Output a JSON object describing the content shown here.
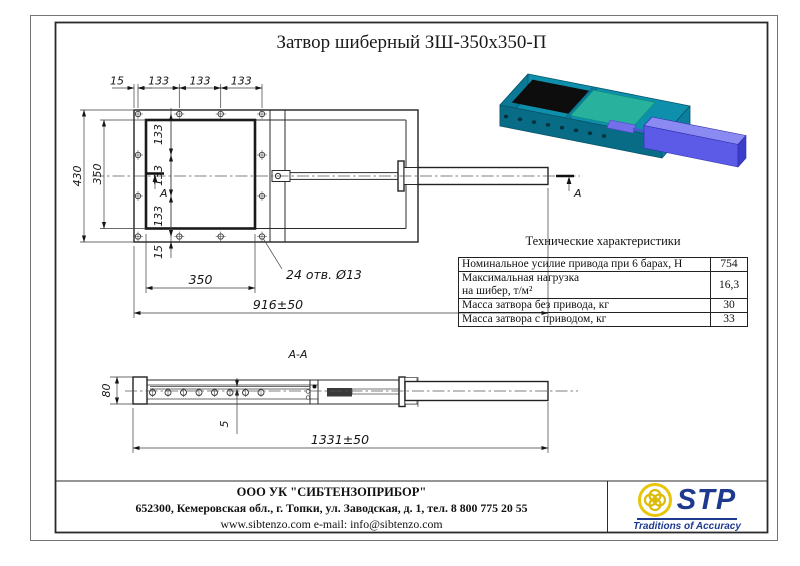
{
  "page": {
    "title": "Затвор шиберный ЗШ-350х350-П"
  },
  "drawing": {
    "main_view": {
      "top_dims": [
        "15",
        "133",
        "133",
        "133"
      ],
      "height_dim": "430",
      "opening_height_dim": "350",
      "row_dims": [
        "133",
        "133",
        "133",
        "15"
      ],
      "opening_width_dim": "350",
      "length_dim": "916±50",
      "holes_note": "24 отв. Ø13",
      "section_mark": "А"
    },
    "section_view": {
      "title": "А-А",
      "height_dim": "80",
      "plate_dim": "5",
      "length_dim": "1331±50"
    }
  },
  "specs": {
    "title": "Технические характеристики",
    "rows": [
      {
        "label": "Номинальное усилие привода при 6 барах, Н",
        "value": "754"
      },
      {
        "label": "Максимальная нагрузка\nна шибер, т/м²",
        "value": "16,3"
      },
      {
        "label": "Масса затвора без привода, кг",
        "value": "30"
      },
      {
        "label": "Масса затвора с приводом, кг",
        "value": "33"
      }
    ]
  },
  "footer": {
    "company": "ООО УК \"СИБТЕНЗОПРИБОР\"",
    "address": "652300, Кемеровская обл., г. Топки, ул. Заводская, д. 1, тел. 8 800 775 20 55",
    "contacts": "www.sibtenzo.com e-mail: info@sibtenzo.com",
    "logo_text": "STP",
    "logo_tagline": "Traditions of Accuracy"
  },
  "colors": {
    "body_teal": "#0E8FAC",
    "gate_green": "#28B29D",
    "cylinder_blue": "#5B5BE8",
    "logo_blue": "#1E3A8F",
    "logo_yellow": "#E8C50A"
  }
}
